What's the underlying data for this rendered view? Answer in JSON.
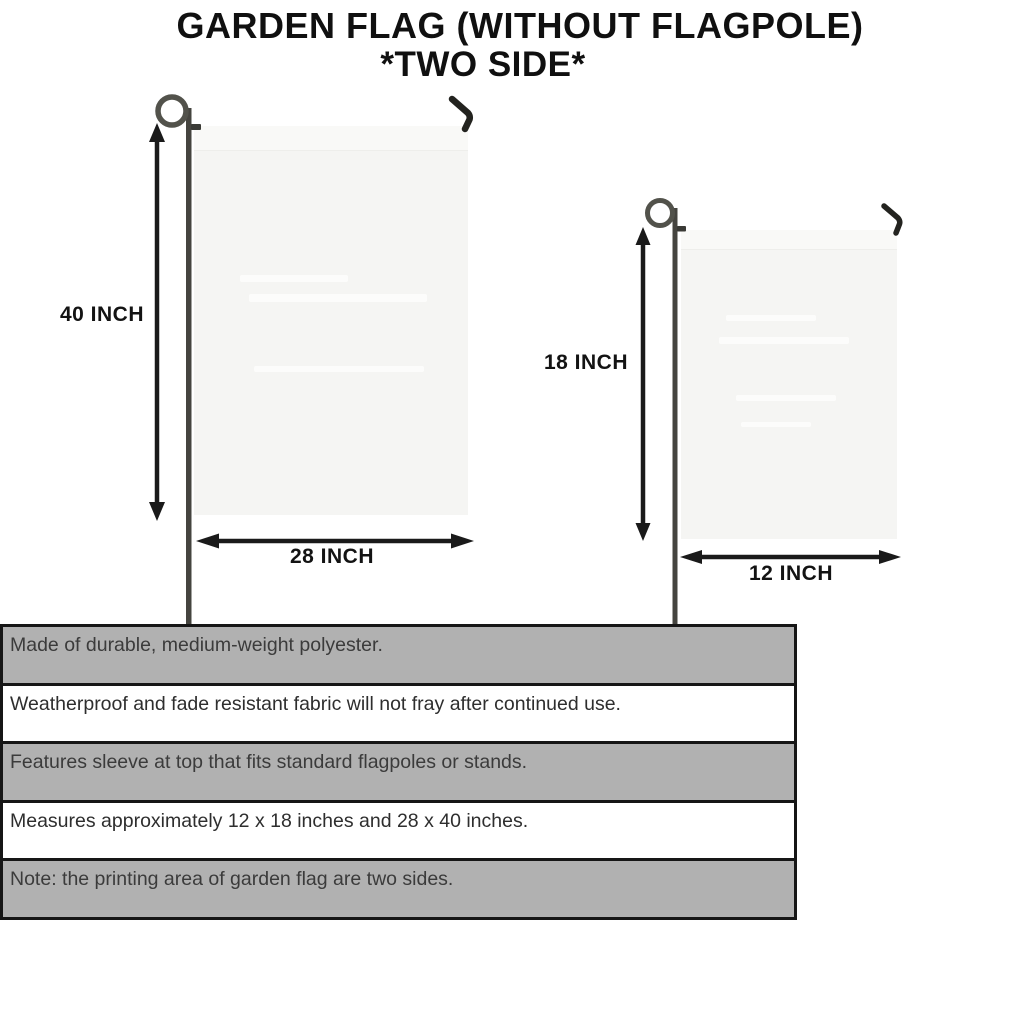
{
  "title": {
    "line1": "GARDEN FLAG (WITHOUT FLAGPOLE)",
    "line2": "*TWO SIDE*"
  },
  "flags": {
    "large": {
      "height_label": "40 INCH",
      "width_label": "28 INCH"
    },
    "small": {
      "height_label": "18 INCH",
      "width_label": "12 INCH"
    }
  },
  "features": [
    "Made of durable, medium-weight polyester.",
    "Weatherproof and fade resistant fabric will not fray after continued use.",
    "Features sleeve at top that fits standard flagpoles or stands.",
    "Measures approximately 12 x 18 inches and 28 x 40 inches.",
    "Note: the printing area of garden flag are two sides."
  ],
  "colors": {
    "background": "#ffffff",
    "flag_fill": "#f5f5f3",
    "table_gray_row": "#b1b1b1",
    "table_border": "#161616",
    "text_dark": "#131313",
    "pole_dark": "#45443f"
  }
}
